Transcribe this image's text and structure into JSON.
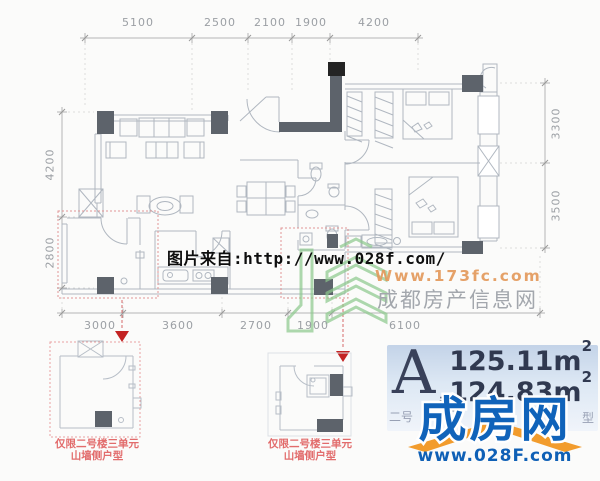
{
  "dims": {
    "top": [
      "5100",
      "2500",
      "2100",
      "1900",
      "4200"
    ],
    "left": [
      "4200",
      "2800"
    ],
    "right": [
      "3300",
      "3500"
    ],
    "bottom": [
      "3000",
      "3600",
      "2700",
      "1900",
      "6100"
    ]
  },
  "watermark": {
    "source_line": "图片来自:http://www.028f.com/",
    "url_173": "Www.173fc.com",
    "site_cn": "成都房产信息网"
  },
  "inset1": {
    "caption_line1": "仅限二号楼三单元",
    "caption_line2": "山墙侧户型"
  },
  "inset2": {
    "caption_line1": "仅限二号楼三单元",
    "caption_line2": "山墙侧户型"
  },
  "badge": {
    "letter": "A",
    "suffix": "型",
    "area_building": "125.11m",
    "area_building_sup": "2",
    "area_inner": "124.83m",
    "area_inner_sup": "2",
    "partial_prefix": "二号",
    "partial_suffix": "型"
  },
  "brand": {
    "name": "成房网",
    "url": "www.028F.com"
  },
  "colors": {
    "accent_blue": "#1063ba",
    "accent_orange": "#f29c2d",
    "red_marker": "#c32323",
    "red_dotted": "#e09595",
    "plan_line": "#b0b7c0",
    "wall_dark": "#5d636b",
    "green_logo": "#8cc98c",
    "badge_navy": "#303950"
  }
}
